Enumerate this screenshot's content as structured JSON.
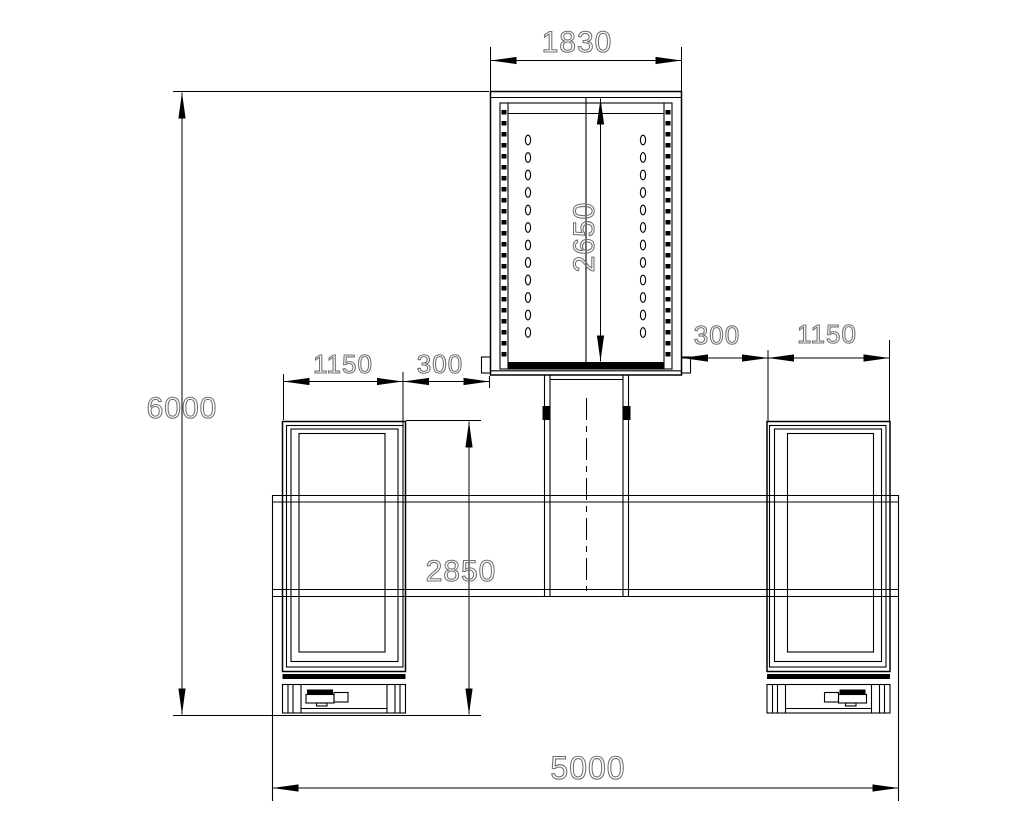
{
  "drawing": {
    "type": "technical-elevation-drawing",
    "dimensions": {
      "top_width": "1830",
      "carriage_height": "2650",
      "overall_height": "6000",
      "left_post_width": "1150",
      "left_gap": "300",
      "right_gap": "300",
      "right_post_width": "1150",
      "post_height": "2850",
      "overall_width": "5000"
    },
    "colors": {
      "line": "#000000",
      "dimension_text": "#6f6f6f",
      "background": "#ffffff"
    }
  }
}
